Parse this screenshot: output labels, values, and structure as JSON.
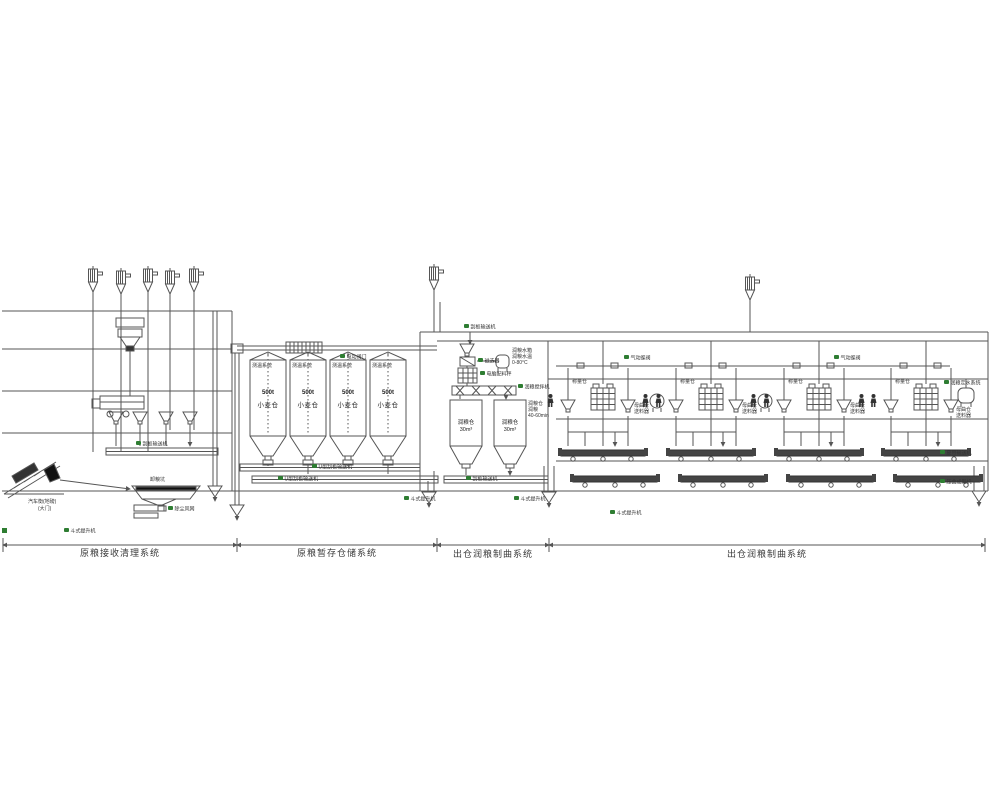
{
  "sections": {
    "receiving": "原粮接收清理系统",
    "storage": "原粮暂存仓储系统",
    "moistening": "出仓润粮制曲系统",
    "koji": "出仓润粮制曲系统"
  },
  "silo": {
    "capacity": "500t",
    "name": "小麦仓",
    "temp_system": "测温系统",
    "valve": "电动阀门"
  },
  "conveyors": {
    "u_scraper": "U型刮板输送机",
    "scraper": "刮板输送机",
    "belt": "皮带输送机"
  },
  "elevator": {
    "bucket": "斗式提升机"
  },
  "receiving_area": {
    "pit": "卸粮坑",
    "truck_scale": "汽车衡(地磅)",
    "gate": "(大门)",
    "dust_net": "除尘风网"
  },
  "moistening_area": {
    "bin": "润粮仓",
    "volume": "30m³",
    "magnet": "磁选器",
    "scale": "电脑配料秤",
    "mixer": "润粮搅拌机",
    "water_tank": "润粮水箱",
    "water_temp": "润粮水温",
    "temp_range": "0-80°C",
    "soak_bin": "润粮仓",
    "soak": "润粮",
    "soak_time": "40-60min",
    "water_system": "润粮定水系统"
  },
  "koji_area": {
    "valve": "气动蝶阀",
    "weigh_bin": "称量仓",
    "mother_bin": "母曲仓",
    "feeder": "送料器",
    "press": "压曲成型机"
  },
  "colors": {
    "line": "#555555",
    "tag_green": "#2e7d32",
    "dark_fill": "#333333"
  }
}
